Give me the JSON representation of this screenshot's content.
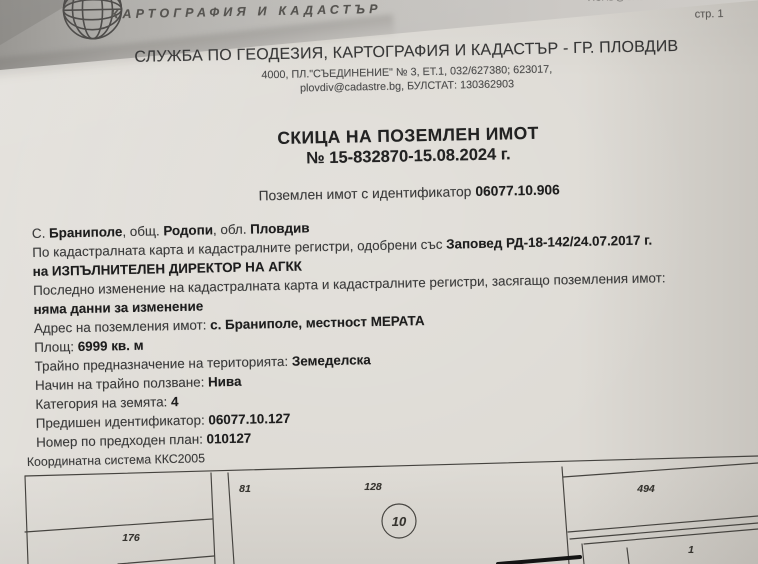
{
  "letterhead": {
    "brand_text": "КАРТОГРАФИЯ И КАДАСТЪР",
    "logo_icon": "globe-icon",
    "top_email": "ACAD@CADASTRE.BG",
    "page_label": "стр. 1"
  },
  "header": {
    "office": "СЛУЖБА ПО ГЕОДЕЗИЯ, КАРТОГРАФИЯ И КАДАСТЪР - ГР. ПЛОВДИВ",
    "address_line1": "4000, ПЛ.\"СЪЕДИНЕНИЕ\" № 3, ЕТ.1, 032/627380; 623017,",
    "address_line2": "plovdiv@cadastre.bg, БУЛСТАТ: 130362903"
  },
  "title": {
    "main": "СКИЦА НА ПОЗЕМЛЕН ИМОТ",
    "number": "№ 15-832870-15.08.2024 г."
  },
  "subject": {
    "label": "Поземлен имот с идентификатор",
    "id": "06077.10.906"
  },
  "details": {
    "lines": [
      [
        {
          "t": "С. "
        },
        {
          "t": "Браниполе",
          "b": true
        },
        {
          "t": ", общ. "
        },
        {
          "t": "Родопи",
          "b": true
        },
        {
          "t": ", обл. "
        },
        {
          "t": "Пловдив",
          "b": true
        }
      ],
      [
        {
          "t": "По кадастралната карта и кадастралните регистри, одобрени със "
        },
        {
          "t": "Заповед РД-18-142/24.07.2017 г.",
          "b": true
        }
      ],
      [
        {
          "t": "на ИЗПЪЛНИТЕЛЕН ДИРЕКТОР НА АГКК",
          "b": true
        }
      ],
      [
        {
          "t": "Последно изменение на кадастралната карта и кадастралните регистри, засягащо поземления имот:"
        }
      ],
      [
        {
          "t": "няма данни за изменение",
          "b": true
        }
      ],
      [
        {
          "t": "Адрес на поземления имот: "
        },
        {
          "t": "с. Браниполе, местност МЕРАТА",
          "b": true
        }
      ],
      [
        {
          "t": "Площ: "
        },
        {
          "t": "6999 кв. м",
          "b": true
        }
      ],
      [
        {
          "t": "Трайно предназначение на територията: "
        },
        {
          "t": "Земеделска",
          "b": true
        }
      ],
      [
        {
          "t": "Начин на трайно ползване: "
        },
        {
          "t": "Нива",
          "b": true
        }
      ],
      [
        {
          "t": "Категория на земята: "
        },
        {
          "t": "4",
          "b": true
        }
      ],
      [
        {
          "t": "Предишен идентификатор: "
        },
        {
          "t": "06077.10.127",
          "b": true
        }
      ],
      [
        {
          "t": "Номер по предходен план: "
        },
        {
          "t": "010127",
          "b": true
        }
      ]
    ]
  },
  "map": {
    "coordinate_system_label": "Координатна система ККС2005",
    "circled_parcel": "10",
    "parcels": [
      "81",
      "176",
      "128",
      "494",
      "1"
    ]
  },
  "colors": {
    "paper": "#dedbd5",
    "band_grey": "#b0aeaa",
    "ink": "#383838",
    "bold_ink": "#1d1d1d",
    "map_line": "#45433f"
  }
}
